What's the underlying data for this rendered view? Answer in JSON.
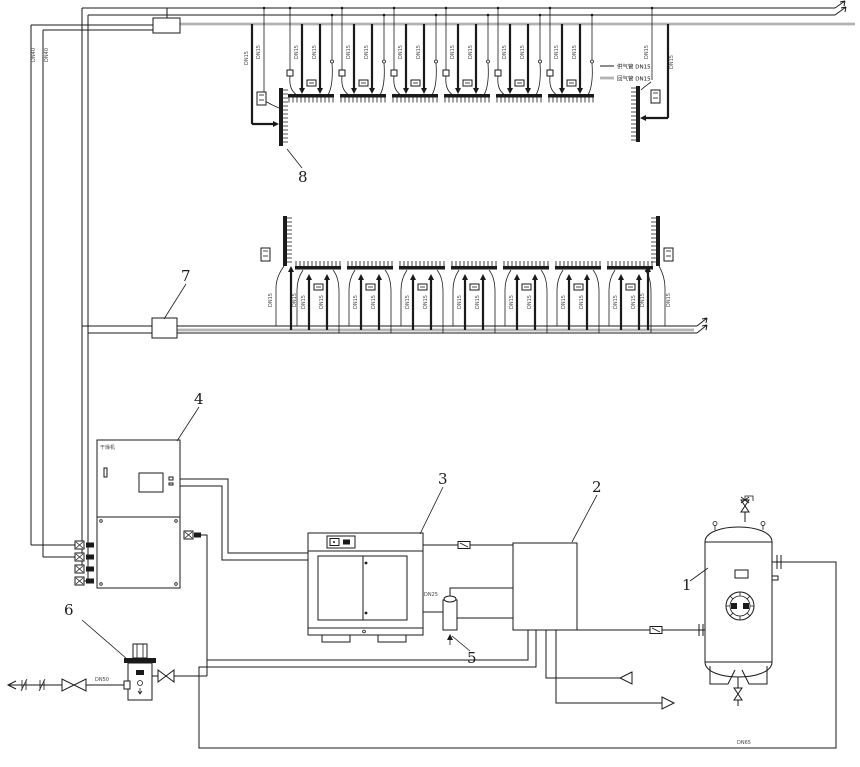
{
  "components": {
    "c1": "1",
    "c2": "2",
    "c3": "3",
    "c4": "4",
    "c5": "5",
    "c6": "6",
    "c7": "7",
    "c8": "8"
  },
  "cabinet_text": "干燥机",
  "pipe_labels": {
    "dn40_a": "DN40",
    "dn40_b": "DN40",
    "dn15": "DN15",
    "dn25": "DN25",
    "dn50": "DN50",
    "dn65": "DN65"
  },
  "legend": {
    "item1": "供气管 DN15",
    "item2": "回气管 DN15"
  },
  "rows": {
    "top_units_x": [
      288,
      340,
      392,
      444,
      496,
      548
    ],
    "mid_units_x": [
      295,
      347,
      399,
      451,
      503,
      555,
      607
    ]
  },
  "colors": {
    "line": "#1a1a1a",
    "gray_pipe": "#b3b3b3"
  }
}
